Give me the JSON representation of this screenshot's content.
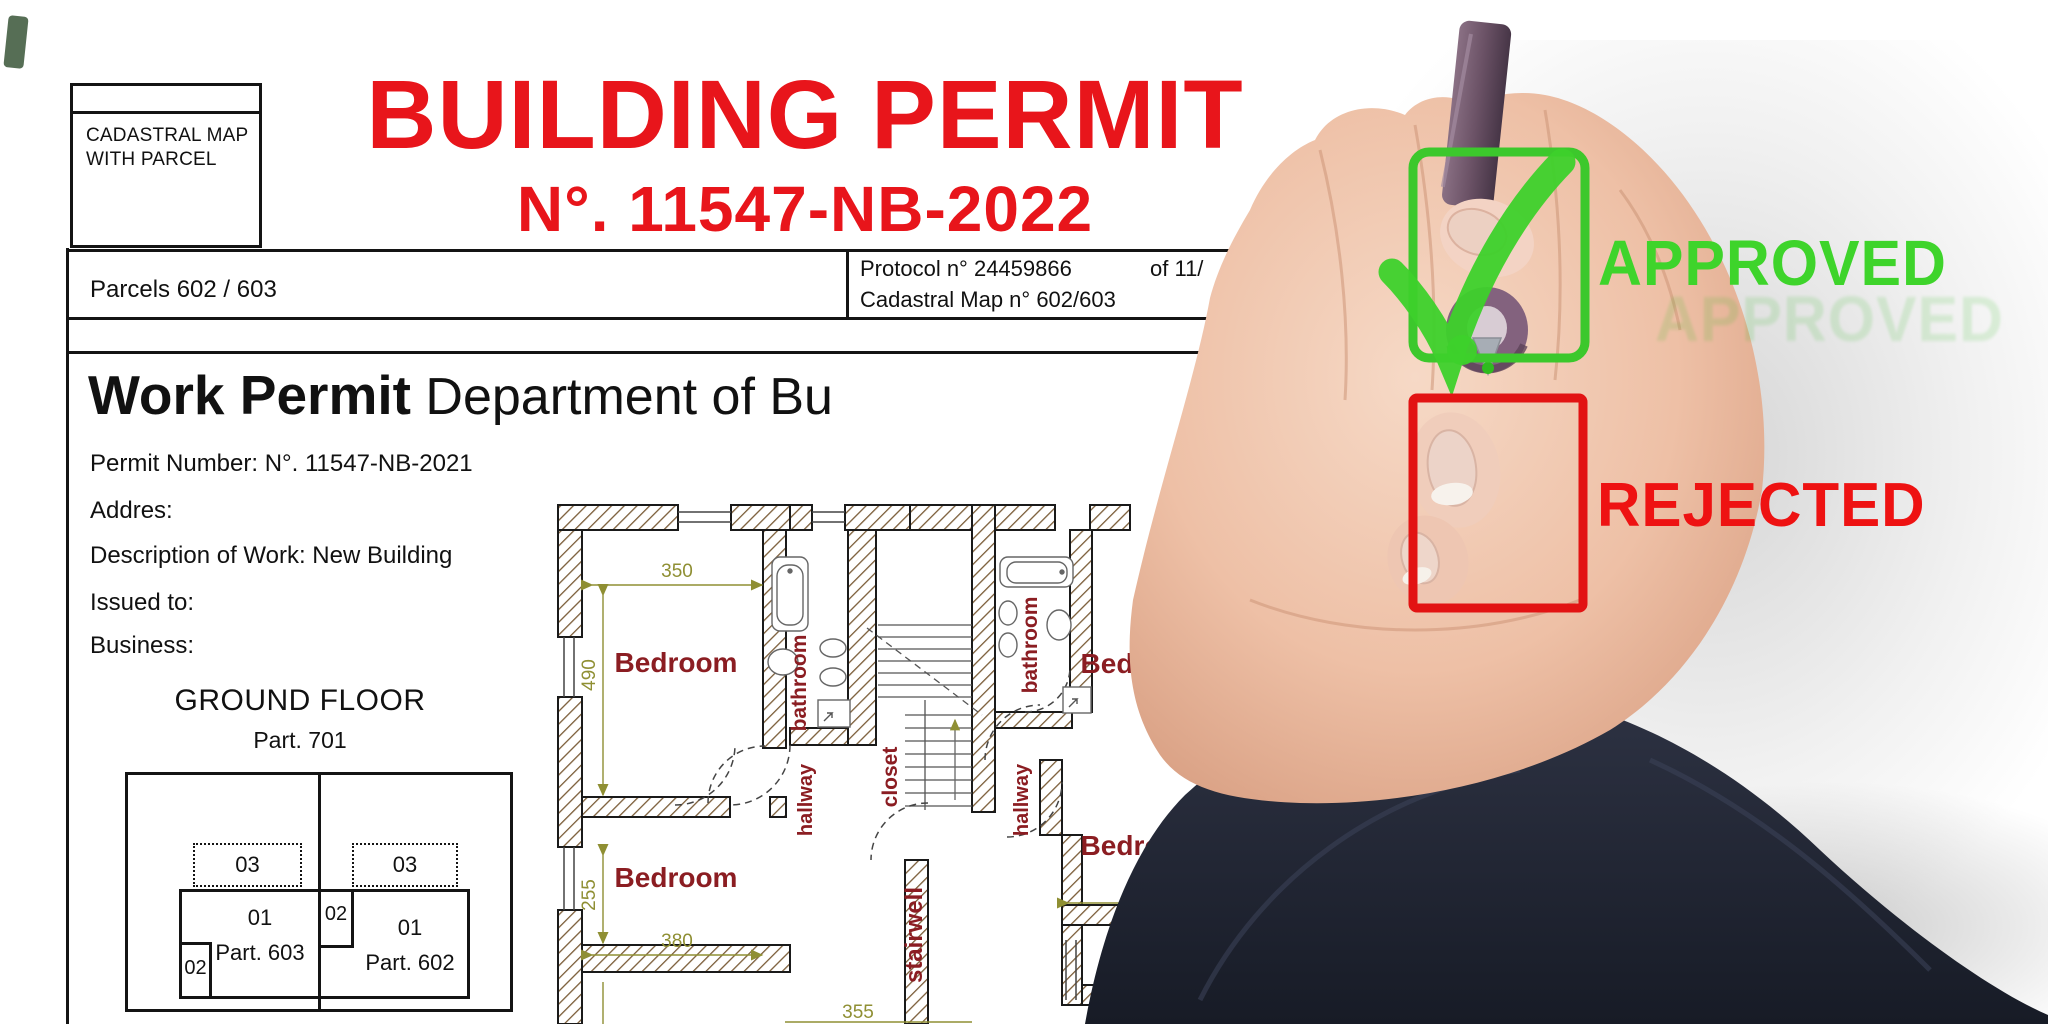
{
  "header": {
    "cadastral_box_line1": "CADASTRAL MAP",
    "cadastral_box_line2": "WITH PARCEL",
    "title": "BUILDING PERMIT",
    "permit_no": "N°. 11547-NB-2022"
  },
  "info_row": {
    "parcels": "Parcels 602 / 603",
    "protocol": "Protocol n° 24459866",
    "protocol_of": "of 11/",
    "cadastral_map": "Cadastral Map n° 602/603"
  },
  "body": {
    "heading_bold": "Work Permit",
    "heading_rest": " Department of Bu",
    "permit_number": "Permit Number: N°. 11547-NB-2021",
    "address": "Addres:",
    "description": "Description of Work: New Building",
    "issued_to": "Issued to:",
    "business": "Business:"
  },
  "ground_floor": {
    "title": "GROUND FLOOR",
    "subtitle": "Part. 701",
    "parcel_03_left": "03",
    "parcel_03_right": "03",
    "parcel_01_left": "01",
    "parcel_01_left_name": "Part. 603",
    "parcel_02_left": "02",
    "parcel_02_mid": "02",
    "parcel_01_right": "01",
    "parcel_01_right_name": "Part. 602"
  },
  "floor_plan": {
    "bedroom1": "Bedroom",
    "bedroom2": "Bedroom",
    "bedroom3": "Bedroom",
    "bedroom4": "Bedroom",
    "bathroom1": "bathroom",
    "bathroom2": "bathroom",
    "closet": "closet",
    "hallway1": "hallway",
    "hallway2": "hallway",
    "stairwell": "stairwell",
    "dim_350": "350",
    "dim_490": "490",
    "dim_255": "255",
    "dim_380": "380",
    "dim_360": "360",
    "dim_225": "225",
    "dim_355": "355"
  },
  "stamp": {
    "approved": "APPROVED",
    "approved_ghost": "APPROVED",
    "rejected": "REJECTED",
    "approved_color": "#3ed42b",
    "rejected_color": "#ee1212",
    "checkbox_green": "#3cc82c",
    "checkbox_red": "#e21313",
    "title_red": "#e8151b",
    "room_label_color": "#8b1d22",
    "dimension_color": "#8f8f33"
  }
}
